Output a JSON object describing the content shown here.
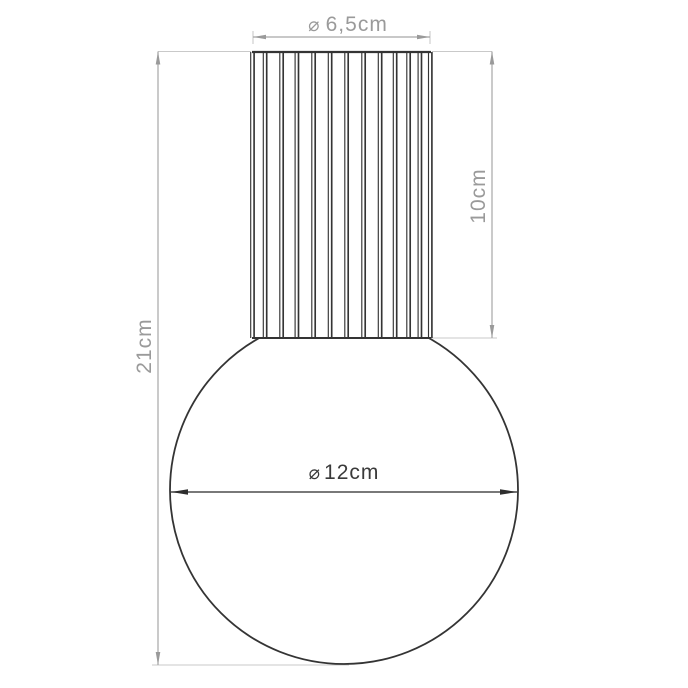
{
  "dimensions": {
    "shade_diameter": {
      "symbol": "⌀",
      "value": "6,5cm"
    },
    "shade_height": {
      "value": "10cm"
    },
    "total_height": {
      "value": "21cm"
    },
    "globe_diameter": {
      "symbol": "⌀",
      "value": "12cm"
    }
  },
  "colors": {
    "outline_dark": "#343434",
    "dim_line_gray": "#a6a6a6",
    "arrow_gray": "#9a9a9a",
    "dim_text_gray": "#9a9a9a",
    "dim_line_dark": "#4d4d4d",
    "arrow_dark": "#2e2e2e",
    "dim_text_dark": "#3a3a3a",
    "extension_gray": "#c9c9c9",
    "background": "#ffffff"
  }
}
